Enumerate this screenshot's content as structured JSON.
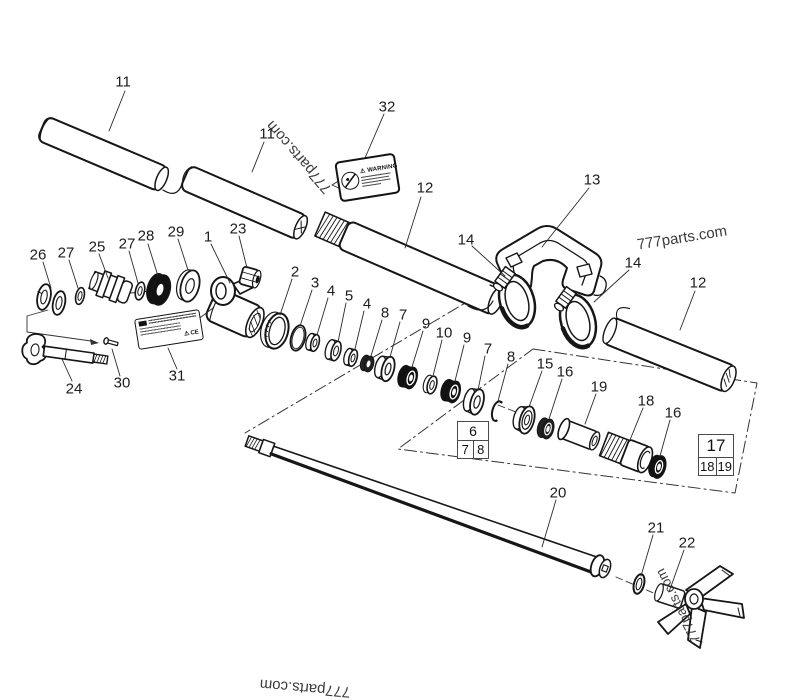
{
  "canvas": {
    "width": 800,
    "height": 683,
    "background": "#ffffff",
    "ink": "#1a1a1a"
  },
  "watermarks": [
    {
      "text": "777parts.com"
    },
    {
      "text": "777parts.com"
    },
    {
      "text": "777parts.com"
    },
    {
      "text": "777parts.com"
    }
  ],
  "callouts": [
    {
      "t": "11",
      "x": 123,
      "y": 82
    },
    {
      "t": "11",
      "x": 267,
      "y": 134
    },
    {
      "t": "32",
      "x": 387,
      "y": 107
    },
    {
      "t": "12",
      "x": 425,
      "y": 188
    },
    {
      "t": "13",
      "x": 592,
      "y": 180
    },
    {
      "t": "14",
      "x": 466,
      "y": 240
    },
    {
      "t": "14",
      "x": 633,
      "y": 263
    },
    {
      "t": "12",
      "x": 698,
      "y": 283
    },
    {
      "t": "26",
      "x": 38,
      "y": 255
    },
    {
      "t": "27",
      "x": 66,
      "y": 253
    },
    {
      "t": "25",
      "x": 97,
      "y": 247
    },
    {
      "t": "27",
      "x": 127,
      "y": 244
    },
    {
      "t": "28",
      "x": 146,
      "y": 236
    },
    {
      "t": "29",
      "x": 176,
      "y": 232
    },
    {
      "t": "1",
      "x": 208,
      "y": 237
    },
    {
      "t": "23",
      "x": 238,
      "y": 229
    },
    {
      "t": "2",
      "x": 295,
      "y": 272
    },
    {
      "t": "3",
      "x": 315,
      "y": 283
    },
    {
      "t": "4",
      "x": 331,
      "y": 291
    },
    {
      "t": "5",
      "x": 349,
      "y": 296
    },
    {
      "t": "4",
      "x": 367,
      "y": 304
    },
    {
      "t": "8",
      "x": 385,
      "y": 313
    },
    {
      "t": "7",
      "x": 403,
      "y": 315
    },
    {
      "t": "9",
      "x": 426,
      "y": 324
    },
    {
      "t": "10",
      "x": 444,
      "y": 333
    },
    {
      "t": "9",
      "x": 467,
      "y": 338
    },
    {
      "t": "7",
      "x": 488,
      "y": 349
    },
    {
      "t": "8",
      "x": 511,
      "y": 357
    },
    {
      "t": "15",
      "x": 545,
      "y": 364
    },
    {
      "t": "16",
      "x": 565,
      "y": 372
    },
    {
      "t": "19",
      "x": 599,
      "y": 387
    },
    {
      "t": "18",
      "x": 646,
      "y": 401
    },
    {
      "t": "16",
      "x": 673,
      "y": 413
    },
    {
      "t": "31",
      "x": 177,
      "y": 376
    },
    {
      "t": "24",
      "x": 74,
      "y": 389
    },
    {
      "t": "30",
      "x": 122,
      "y": 383
    },
    {
      "t": "20",
      "x": 558,
      "y": 493
    },
    {
      "t": "21",
      "x": 656,
      "y": 528
    },
    {
      "t": "22",
      "x": 687,
      "y": 543
    }
  ],
  "tables": {
    "t6": {
      "header": "6",
      "c1": "7",
      "c2": "8"
    },
    "t17": {
      "header": "17",
      "c1": "18",
      "c2": "19"
    }
  },
  "labels": {
    "warning_title": "WARNING",
    "ce_mark": "CE"
  }
}
